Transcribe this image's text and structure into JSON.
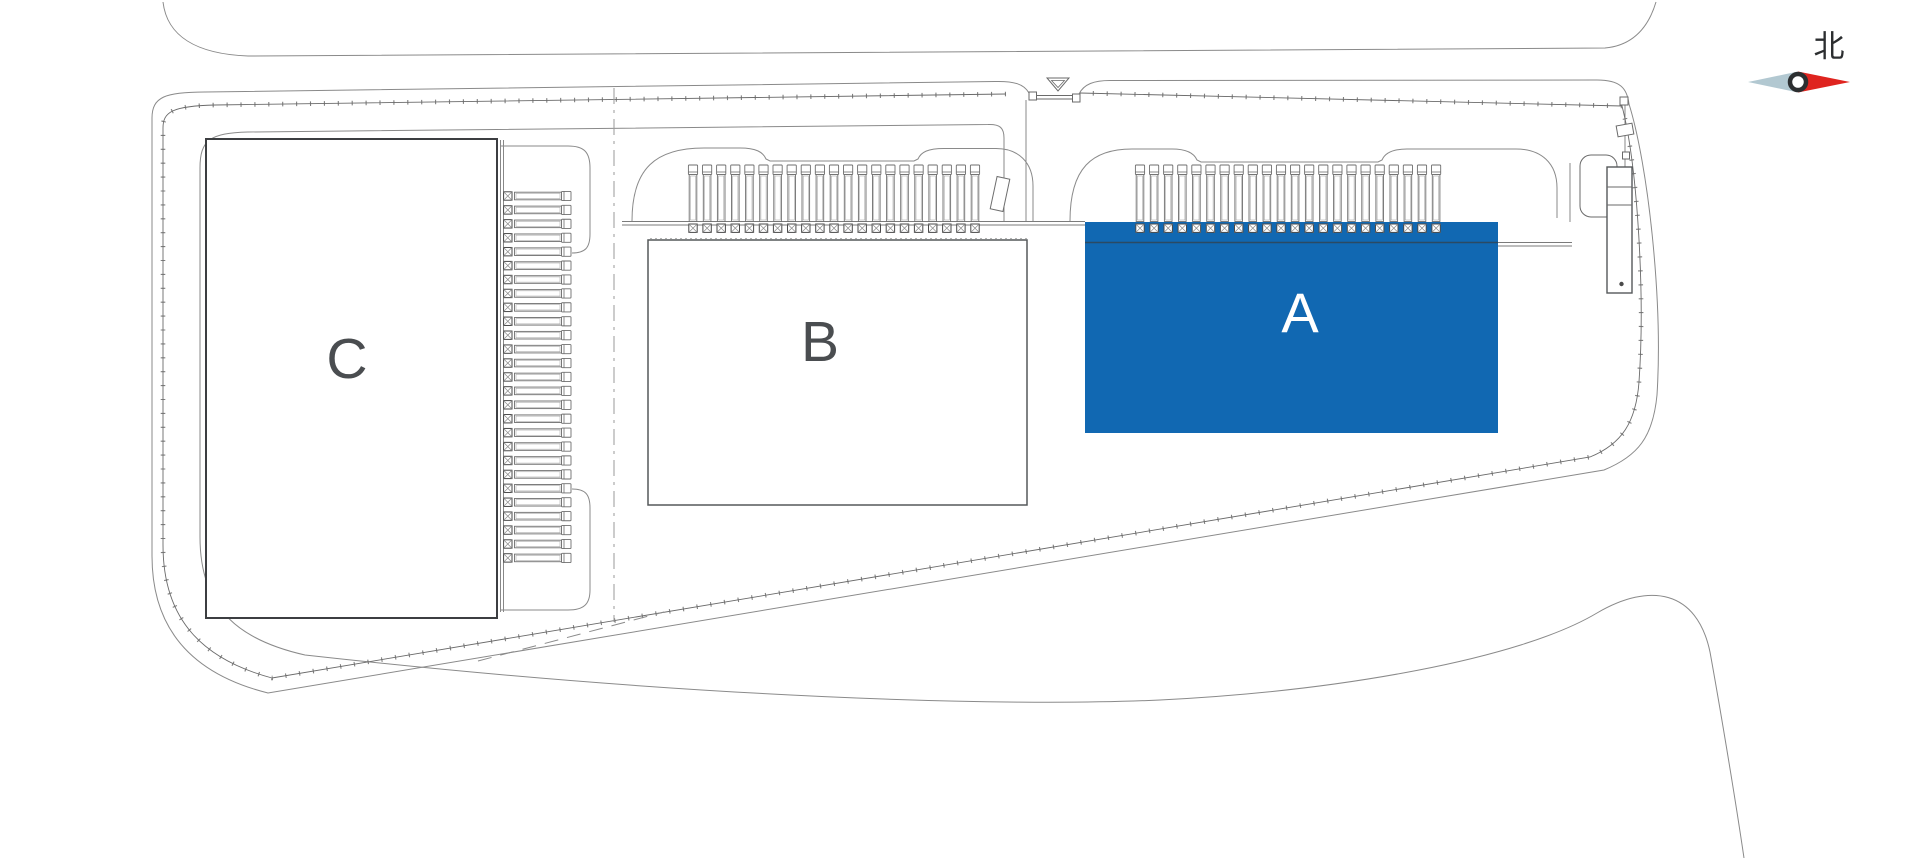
{
  "site_plan": {
    "background": "#ffffff",
    "compass": {
      "label": "北",
      "needle_red": "#df241f",
      "needle_gray": "#b2c8d1",
      "ring_color": "#2c2e30",
      "text_color": "#2c2e30"
    },
    "buildings": [
      {
        "id": "A",
        "label": "A",
        "selected": true,
        "fill": "#1168b2",
        "stroke": "#0d5a9c",
        "label_color": "#ffffff"
      },
      {
        "id": "B",
        "label": "B",
        "selected": false,
        "fill": "#ffffff",
        "stroke": "#55585a",
        "label_color": "#4a4d50"
      },
      {
        "id": "C",
        "label": "C",
        "selected": false,
        "fill": "#ffffff",
        "stroke": "#3c3e41",
        "label_color": "#4a4d50"
      }
    ],
    "dock_rows": [
      {
        "building": "A",
        "orientation": "up",
        "count": 22,
        "start": 1140,
        "spacing": 14.1,
        "origin": 165
      },
      {
        "building": "B",
        "orientation": "up",
        "count": 21,
        "start": 693,
        "spacing": 14.1,
        "origin": 165
      },
      {
        "building": "C",
        "orientation": "right",
        "count": 27,
        "start": 196,
        "spacing": 13.92,
        "origin": 571
      }
    ],
    "colors": {
      "thin_line": "#8a8a8a",
      "fence_line": "#6a6a6a",
      "dark_line": "#3e4043",
      "building_a_top_edge": "#2b4a63"
    }
  }
}
